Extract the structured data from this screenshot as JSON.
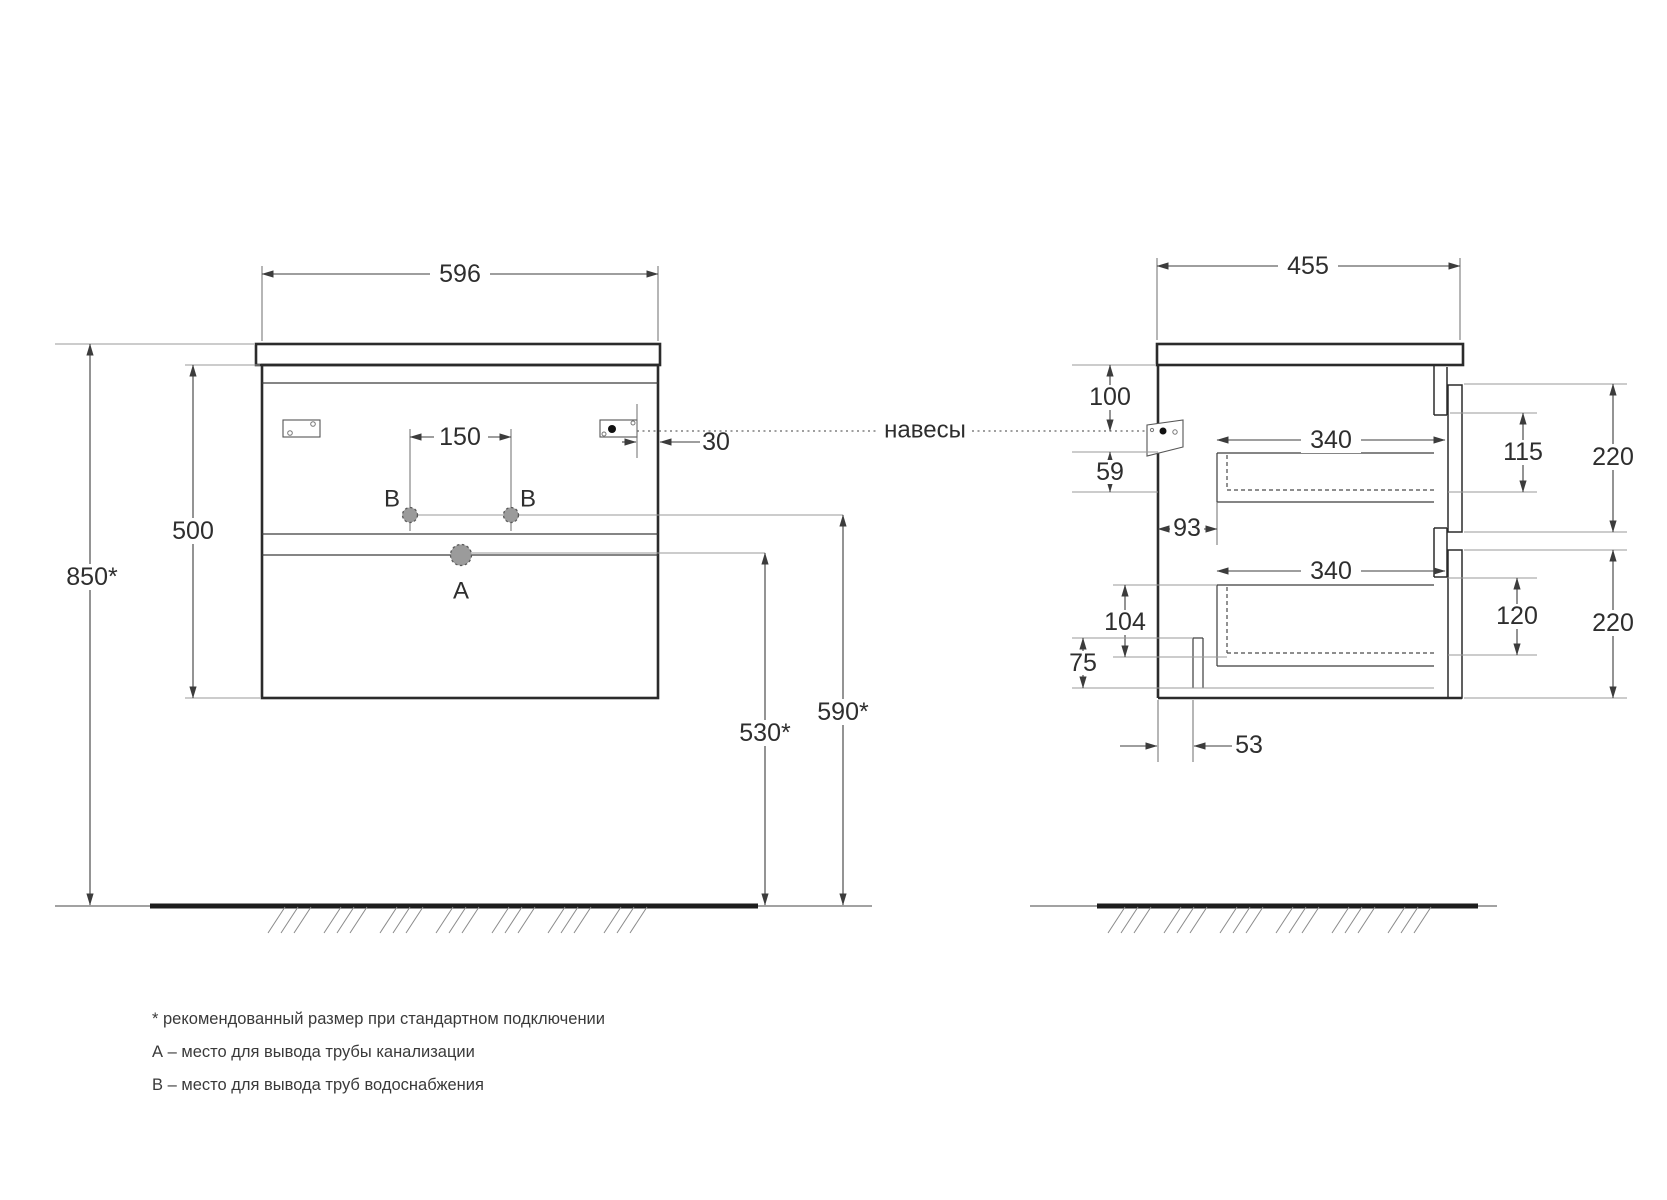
{
  "front_view": {
    "width_label": "596",
    "height_label": "500",
    "install_height_label": "850*",
    "holes_spacing_label": "150",
    "hanger_inset_label": "30",
    "hole_b_label": "В",
    "hole_a_label": "А",
    "drain_height_label": "530*",
    "supply_height_label": "590*"
  },
  "side_view": {
    "depth_label": "455",
    "top_clearance_label": "100",
    "hanger_to_drawer_label": "59",
    "back_clearance_label": "93",
    "upper_drawer_length_label": "340",
    "upper_drawer_inner_label": "115",
    "upper_front_height_label": "220",
    "lower_drawer_length_label": "340",
    "lower_drawer_inner_label": "120",
    "lower_front_height_label": "220",
    "lower_drawer_floor_label": "104",
    "recess_height_label": "75",
    "recess_depth_label": "53"
  },
  "annotations": {
    "hangers_label": "навесы",
    "footnote_asterisk": "* рекомендованный размер при стандартном подключении",
    "footnote_a": "А – место для вывода трубы канализации",
    "footnote_b": "В – место для вывода труб водоснабжения"
  },
  "colors": {
    "main_line": "#2b2b2b",
    "aux_line": "#9a9a9a",
    "hole_fill": "#9b9b9b",
    "background": "#ffffff"
  }
}
